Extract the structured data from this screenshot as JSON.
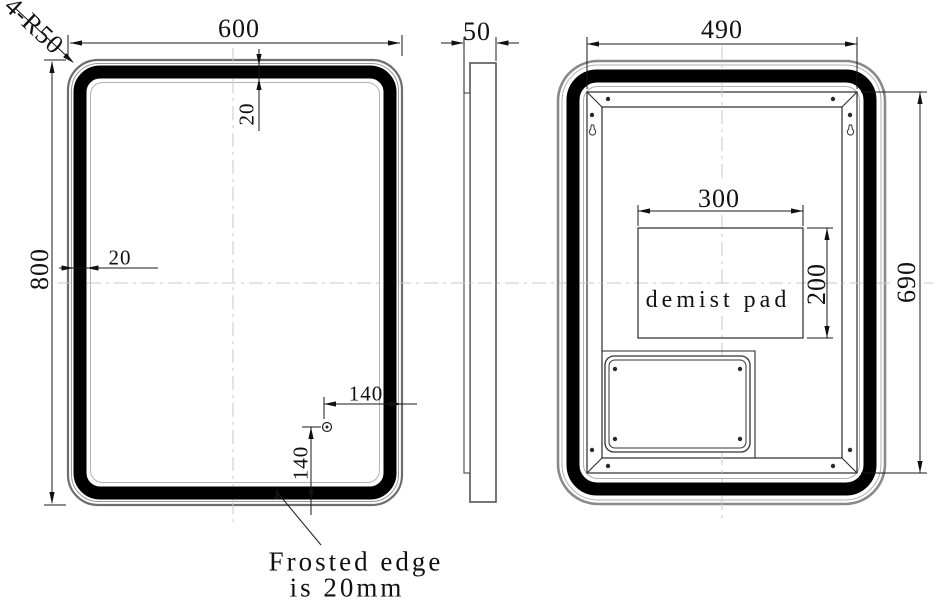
{
  "front_view": {
    "width": "600",
    "height": "800",
    "corner_radius": "4-R50",
    "frost_width_top": "20",
    "frost_width_side": "20",
    "sensor_offset_right": "140",
    "sensor_offset_bottom": "140"
  },
  "side_view": {
    "depth": "50"
  },
  "back_view": {
    "width": "490",
    "height": "690",
    "pad_width": "300",
    "pad_height": "200",
    "pad_label": "demist pad"
  },
  "note": {
    "line1": "Frosted edge",
    "line2": "is 20mm"
  },
  "colors": {
    "line": "#1a1a1a",
    "silver_edge": "#8a8a8a",
    "led_band": "#000000",
    "centerline": "#c8c8c8",
    "background": "#ffffff"
  }
}
